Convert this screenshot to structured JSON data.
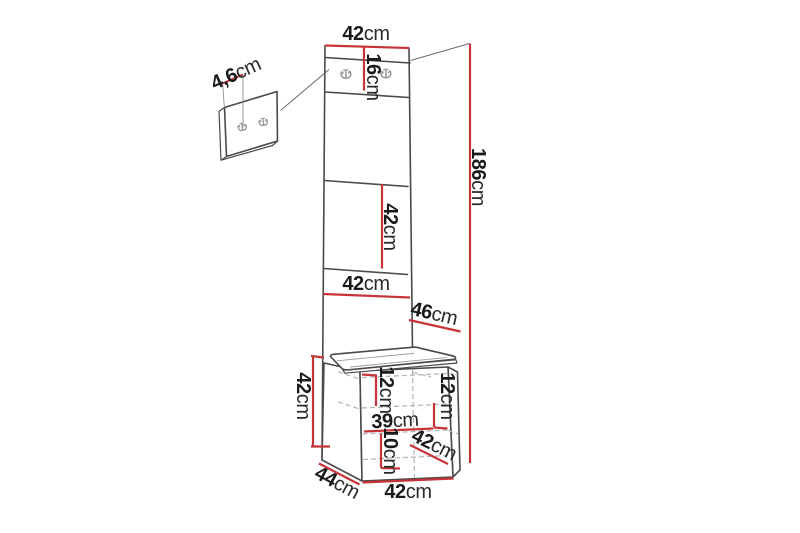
{
  "image": {
    "type": "furniture-dimension-diagram",
    "product": "hallway wardrobe column with hook panels and storage bench",
    "background_color": "#ffffff",
    "dimension_line_color": "#c63438",
    "outline_color": "#4a4a4a",
    "dimensions": {
      "top_width": {
        "value": "42",
        "unit": "cm"
      },
      "hook_strip_height": {
        "value": "16",
        "unit": "cm"
      },
      "small_panel_depth": {
        "value": "4,6",
        "unit": "cm"
      },
      "total_height": {
        "value": "186",
        "unit": "cm"
      },
      "middle_panel_height": {
        "value": "42",
        "unit": "cm"
      },
      "lower_panel_width": {
        "value": "42",
        "unit": "cm"
      },
      "upper_side_depth": {
        "value": "46",
        "unit": "cm"
      },
      "bench_side_height": {
        "value": "42",
        "unit": "cm"
      },
      "bench_inner_left_height": {
        "value": "12",
        "unit": "cm"
      },
      "bench_inner_right_height": {
        "value": "12",
        "unit": "cm"
      },
      "bench_inner_width": {
        "value": "39",
        "unit": "cm"
      },
      "bench_lower_inner_height": {
        "value": "10",
        "unit": "cm"
      },
      "bench_seat_depth": {
        "value": "42",
        "unit": "cm"
      },
      "bench_floor_depth": {
        "value": "44",
        "unit": "cm"
      },
      "bench_front_width": {
        "value": "42",
        "unit": "cm"
      }
    }
  }
}
